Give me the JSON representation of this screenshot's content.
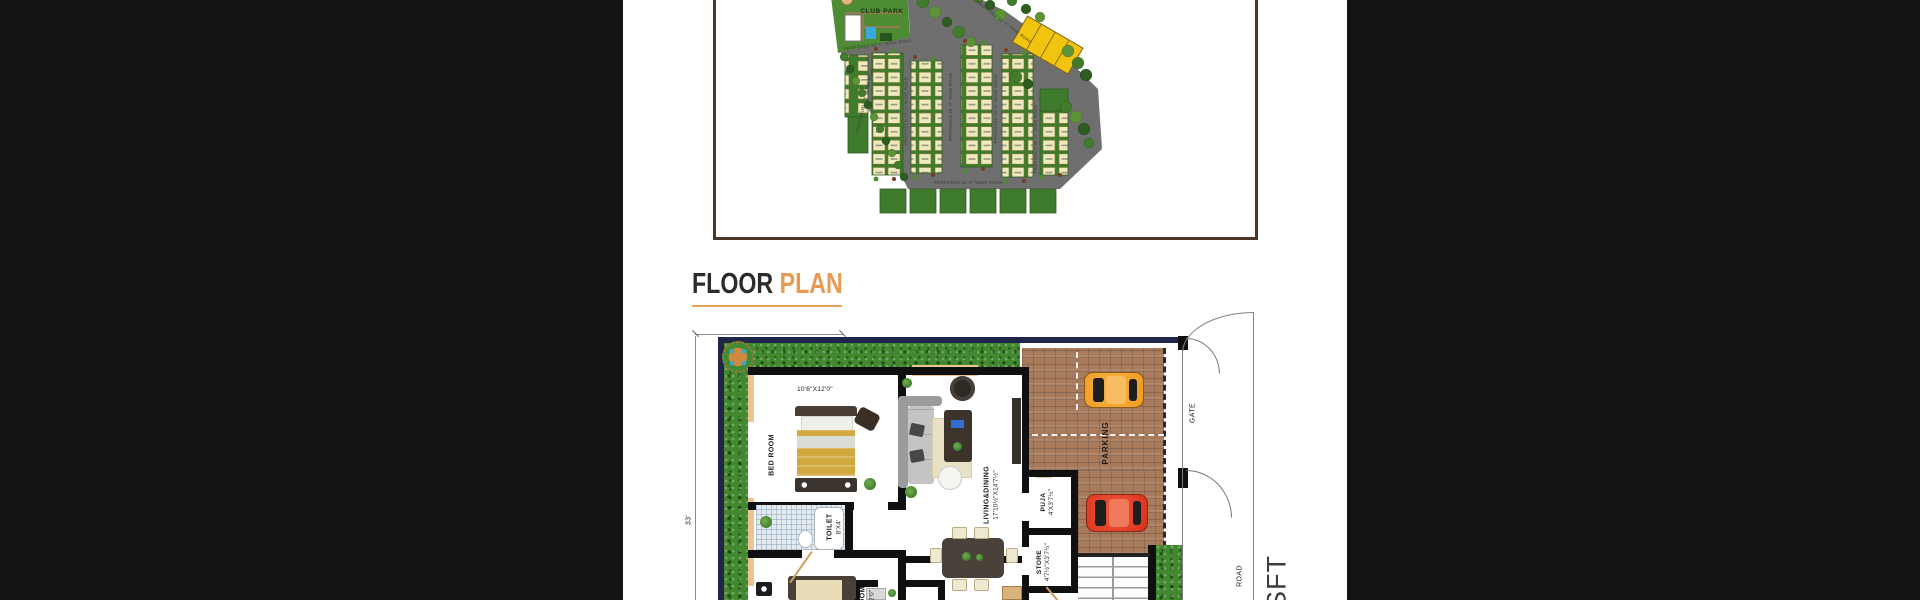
{
  "page": {
    "bg": "#131313",
    "panel_bg": "#ffffff"
  },
  "site_plan": {
    "club_park_label": "CLUB PARK",
    "road_label": "PROPOSED 33'-0\" WIDE ROAD",
    "plot_color": "#efe8c0",
    "strip_color": "#3e7b2d",
    "road_color": "#6f6f6f",
    "premium_plot_color": "#f1c40f",
    "border_color": "#4a392b"
  },
  "heading": {
    "word1": "FLOOR",
    "word2": "PLAN",
    "accent": "#e79b52"
  },
  "floor_plan": {
    "dims": {
      "left_height": "33'"
    },
    "bed_room": {
      "name": "BED ROOM",
      "dim": "10'6\"X12'0\""
    },
    "bed_room2": {
      "name": "BED ROOM",
      "dim": "10'0\"X12'0\""
    },
    "toilet": {
      "name": "TOILET",
      "dim": "8'X4'"
    },
    "living": {
      "name": "LIVING&DINING",
      "dim": "17'10½\"X14'7½\""
    },
    "puja": {
      "name": "PUJA",
      "dim": "4'X3'7½\""
    },
    "store": {
      "name": "STORE",
      "dim": "4'7½\"X3'7½\""
    },
    "parking_label": "PARKING",
    "gate_label": "GATE",
    "road_label": "ROAD",
    "area_unit": "SFT"
  }
}
